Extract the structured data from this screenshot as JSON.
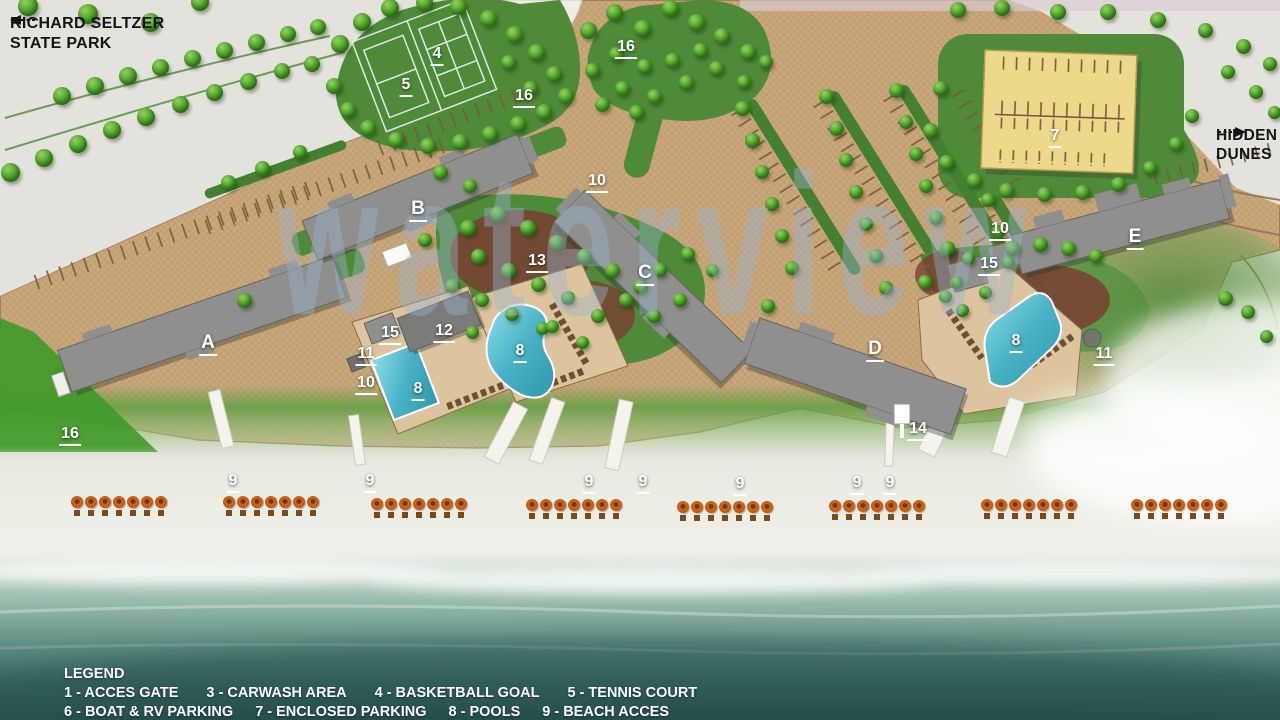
{
  "regions": {
    "state_park": {
      "line1": "RICHARD SELTZER",
      "line2": "STATE PARK"
    },
    "hidden_dunes": {
      "line1": "HIDDEN",
      "line2": "DUNES"
    }
  },
  "watermark": "waterview",
  "legend": {
    "title": "LEGEND",
    "lines": [
      [
        "1 - ACCES GATE",
        "3 - CARWASH AREA",
        "4 - BASKETBALL GOAL",
        "5 - TENNIS COURT"
      ],
      [
        "6 - BOAT & RV PARKING",
        "7 - ENCLOSED PARKING",
        "8 - POOLS",
        "9 - BEACH ACCES"
      ],
      [
        "10 - GRILLS",
        "11 - GAZEBOS",
        "12 - CLUB HOUSE",
        "13 - SHUFFLE BOARD",
        "14 - BEACH SHOWERS"
      ]
    ]
  },
  "colors": {
    "ground_tan": "#c9a87c",
    "green": "#4f8a38",
    "pool_water": "#59c4d6",
    "building_gray": "#8f8f8d",
    "enclosed_parking_yellow": "#ecd98b",
    "ocean_deep": "#2b524e",
    "label_white": "#ffffff"
  },
  "map": {
    "markers": [
      {
        "label": "A",
        "x": 208,
        "y": 333,
        "kind": "building"
      },
      {
        "label": "B",
        "x": 418,
        "y": 199,
        "kind": "building"
      },
      {
        "label": "C",
        "x": 645,
        "y": 263,
        "kind": "building"
      },
      {
        "label": "D",
        "x": 875,
        "y": 339,
        "kind": "building"
      },
      {
        "label": "E",
        "x": 1135,
        "y": 227,
        "kind": "building"
      },
      {
        "label": "4",
        "x": 437,
        "y": 46,
        "kind": "feature"
      },
      {
        "label": "5",
        "x": 406,
        "y": 77,
        "kind": "feature"
      },
      {
        "label": "16",
        "x": 524,
        "y": 88,
        "kind": "feature"
      },
      {
        "label": "16",
        "x": 626,
        "y": 39,
        "kind": "feature"
      },
      {
        "label": "16",
        "x": 70,
        "y": 426,
        "kind": "feature"
      },
      {
        "label": "7",
        "x": 1055,
        "y": 128,
        "kind": "feature"
      },
      {
        "label": "10",
        "x": 597,
        "y": 173,
        "kind": "feature"
      },
      {
        "label": "13",
        "x": 537,
        "y": 253,
        "kind": "feature"
      },
      {
        "label": "10",
        "x": 1000,
        "y": 221,
        "kind": "feature"
      },
      {
        "label": "15",
        "x": 989,
        "y": 256,
        "kind": "feature"
      },
      {
        "label": "8",
        "x": 1016,
        "y": 333,
        "kind": "feature"
      },
      {
        "label": "11",
        "x": 1104,
        "y": 346,
        "kind": "feature"
      },
      {
        "label": "15",
        "x": 390,
        "y": 325,
        "kind": "feature"
      },
      {
        "label": "12",
        "x": 444,
        "y": 323,
        "kind": "feature"
      },
      {
        "label": "11",
        "x": 366,
        "y": 346,
        "kind": "feature"
      },
      {
        "label": "10",
        "x": 366,
        "y": 375,
        "kind": "feature"
      },
      {
        "label": "8",
        "x": 418,
        "y": 381,
        "kind": "feature"
      },
      {
        "label": "8",
        "x": 520,
        "y": 343,
        "kind": "feature"
      },
      {
        "label": "14",
        "x": 918,
        "y": 421,
        "kind": "feature"
      },
      {
        "label": "9",
        "x": 233,
        "y": 473,
        "kind": "feature"
      },
      {
        "label": "9",
        "x": 370,
        "y": 473,
        "kind": "feature"
      },
      {
        "label": "9",
        "x": 589,
        "y": 474,
        "kind": "feature"
      },
      {
        "label": "9",
        "x": 643,
        "y": 474,
        "kind": "feature"
      },
      {
        "label": "9",
        "x": 740,
        "y": 476,
        "kind": "feature"
      },
      {
        "label": "9",
        "x": 857,
        "y": 475,
        "kind": "feature"
      },
      {
        "label": "9",
        "x": 890,
        "y": 475,
        "kind": "feature"
      }
    ],
    "umbrella_groups": [
      {
        "x": 120,
        "y": 496,
        "count": 7
      },
      {
        "x": 272,
        "y": 496,
        "count": 7
      },
      {
        "x": 420,
        "y": 498,
        "count": 7
      },
      {
        "x": 575,
        "y": 499,
        "count": 7
      },
      {
        "x": 726,
        "y": 501,
        "count": 7
      },
      {
        "x": 878,
        "y": 500,
        "count": 7
      },
      {
        "x": 1030,
        "y": 499,
        "count": 7
      },
      {
        "x": 1180,
        "y": 499,
        "count": 7
      }
    ],
    "trees": [
      [
        28,
        6,
        20
      ],
      [
        88,
        14,
        20
      ],
      [
        150,
        22,
        19
      ],
      [
        200,
        2,
        18
      ],
      [
        62,
        96,
        18
      ],
      [
        95,
        86,
        18
      ],
      [
        128,
        76,
        18
      ],
      [
        160,
        67,
        17
      ],
      [
        192,
        58,
        17
      ],
      [
        224,
        50,
        17
      ],
      [
        256,
        42,
        17
      ],
      [
        288,
        34,
        16
      ],
      [
        318,
        27,
        16
      ],
      [
        10,
        172,
        19
      ],
      [
        44,
        158,
        18
      ],
      [
        78,
        144,
        18
      ],
      [
        112,
        130,
        18
      ],
      [
        146,
        117,
        18
      ],
      [
        180,
        104,
        17
      ],
      [
        214,
        92,
        17
      ],
      [
        248,
        81,
        17
      ],
      [
        282,
        71,
        16
      ],
      [
        312,
        64,
        16
      ],
      [
        340,
        44,
        18
      ],
      [
        362,
        22,
        18
      ],
      [
        390,
        8,
        18
      ],
      [
        424,
        2,
        17
      ],
      [
        458,
        6,
        17
      ],
      [
        488,
        18,
        17
      ],
      [
        514,
        34,
        17
      ],
      [
        536,
        52,
        17
      ],
      [
        554,
        74,
        16
      ],
      [
        566,
        96,
        16
      ],
      [
        544,
        112,
        16
      ],
      [
        518,
        124,
        16
      ],
      [
        490,
        134,
        16
      ],
      [
        460,
        142,
        16
      ],
      [
        428,
        146,
        16
      ],
      [
        396,
        140,
        16
      ],
      [
        368,
        128,
        16
      ],
      [
        348,
        110,
        16
      ],
      [
        334,
        86,
        16
      ],
      [
        508,
        62,
        15
      ],
      [
        530,
        88,
        15
      ],
      [
        588,
        30,
        17
      ],
      [
        614,
        12,
        17
      ],
      [
        642,
        28,
        17
      ],
      [
        670,
        8,
        17
      ],
      [
        696,
        22,
        17
      ],
      [
        722,
        36,
        16
      ],
      [
        748,
        52,
        16
      ],
      [
        700,
        50,
        15
      ],
      [
        672,
        60,
        15
      ],
      [
        644,
        66,
        15
      ],
      [
        616,
        54,
        15
      ],
      [
        592,
        70,
        15
      ],
      [
        622,
        88,
        15
      ],
      [
        654,
        96,
        15
      ],
      [
        686,
        82,
        15
      ],
      [
        716,
        68,
        15
      ],
      [
        744,
        82,
        14
      ],
      [
        766,
        62,
        14
      ],
      [
        602,
        104,
        15
      ],
      [
        636,
        112,
        15
      ],
      [
        958,
        10,
        16
      ],
      [
        1002,
        8,
        16
      ],
      [
        1058,
        12,
        16
      ],
      [
        1108,
        12,
        16
      ],
      [
        1158,
        20,
        16
      ],
      [
        1205,
        30,
        15
      ],
      [
        1243,
        46,
        15
      ],
      [
        1270,
        64,
        14
      ],
      [
        1228,
        72,
        14
      ],
      [
        1256,
        92,
        14
      ],
      [
        1274,
        112,
        13
      ],
      [
        940,
        88,
        15
      ],
      [
        930,
        130,
        15
      ],
      [
        946,
        162,
        15
      ],
      [
        974,
        180,
        15
      ],
      [
        1006,
        190,
        15
      ],
      [
        1044,
        194,
        15
      ],
      [
        1082,
        192,
        15
      ],
      [
        1118,
        184,
        15
      ],
      [
        1150,
        168,
        14
      ],
      [
        1176,
        144,
        14
      ],
      [
        1192,
        116,
        14
      ],
      [
        742,
        108,
        15
      ],
      [
        752,
        140,
        15
      ],
      [
        762,
        172,
        14
      ],
      [
        772,
        204,
        14
      ],
      [
        782,
        236,
        14
      ],
      [
        792,
        268,
        14
      ],
      [
        826,
        96,
        15
      ],
      [
        836,
        128,
        15
      ],
      [
        846,
        160,
        14
      ],
      [
        856,
        192,
        14
      ],
      [
        866,
        224,
        14
      ],
      [
        876,
        256,
        14
      ],
      [
        886,
        288,
        14
      ],
      [
        896,
        90,
        15
      ],
      [
        906,
        122,
        14
      ],
      [
        916,
        154,
        14
      ],
      [
        926,
        186,
        14
      ],
      [
        936,
        218,
        14
      ],
      [
        946,
        250,
        14
      ],
      [
        956,
        282,
        13
      ],
      [
        988,
        200,
        14
      ],
      [
        998,
        232,
        14
      ],
      [
        1008,
        262,
        13
      ],
      [
        228,
        182,
        15
      ],
      [
        262,
        168,
        15
      ],
      [
        300,
        152,
        14
      ],
      [
        440,
        172,
        15
      ],
      [
        470,
        186,
        14
      ],
      [
        425,
        240,
        14
      ],
      [
        468,
        228,
        16
      ],
      [
        498,
        214,
        16
      ],
      [
        528,
        228,
        16
      ],
      [
        556,
        242,
        15
      ],
      [
        584,
        256,
        15
      ],
      [
        612,
        270,
        15
      ],
      [
        640,
        286,
        15
      ],
      [
        478,
        256,
        15
      ],
      [
        508,
        270,
        15
      ],
      [
        538,
        284,
        15
      ],
      [
        568,
        298,
        14
      ],
      [
        452,
        286,
        14
      ],
      [
        482,
        300,
        14
      ],
      [
        512,
        314,
        14
      ],
      [
        598,
        316,
        14
      ],
      [
        626,
        300,
        14
      ],
      [
        654,
        316,
        14
      ],
      [
        680,
        300,
        14
      ],
      [
        660,
        270,
        14
      ],
      [
        688,
        254,
        14
      ],
      [
        712,
        270,
        13
      ],
      [
        542,
        328,
        13
      ],
      [
        244,
        300,
        15
      ],
      [
        472,
        332,
        13
      ],
      [
        552,
        326,
        13
      ],
      [
        582,
        342,
        13
      ],
      [
        1012,
        248,
        15
      ],
      [
        1040,
        244,
        15
      ],
      [
        1068,
        248,
        15
      ],
      [
        1096,
        256,
        14
      ],
      [
        948,
        248,
        14
      ],
      [
        968,
        258,
        13
      ],
      [
        925,
        282,
        14
      ],
      [
        945,
        296,
        13
      ],
      [
        962,
        310,
        13
      ],
      [
        1225,
        298,
        15
      ],
      [
        1248,
        312,
        14
      ],
      [
        1266,
        336,
        13
      ],
      [
        768,
        306,
        14
      ],
      [
        985,
        292,
        13
      ]
    ]
  }
}
